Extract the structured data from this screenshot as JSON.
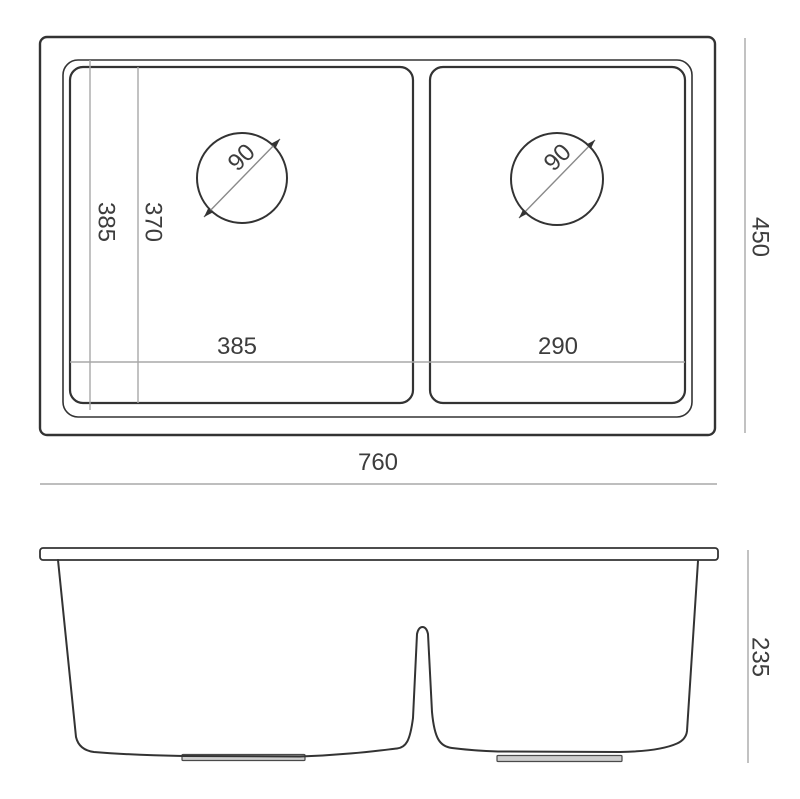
{
  "colors": {
    "outline": "#333333",
    "dimension_line": "#a8a8a8",
    "text": "#3d3d3d",
    "background": "#ffffff"
  },
  "views": {
    "top_view": {
      "overall_width": "760",
      "overall_depth": "450",
      "cutout_depth": "385",
      "bowl_inner_depth": "370",
      "left_bowl_width": "385",
      "right_bowl_width": "290",
      "left_drain_diameter": "90",
      "right_drain_diameter": "90"
    },
    "front_view": {
      "overall_height": "235"
    }
  }
}
